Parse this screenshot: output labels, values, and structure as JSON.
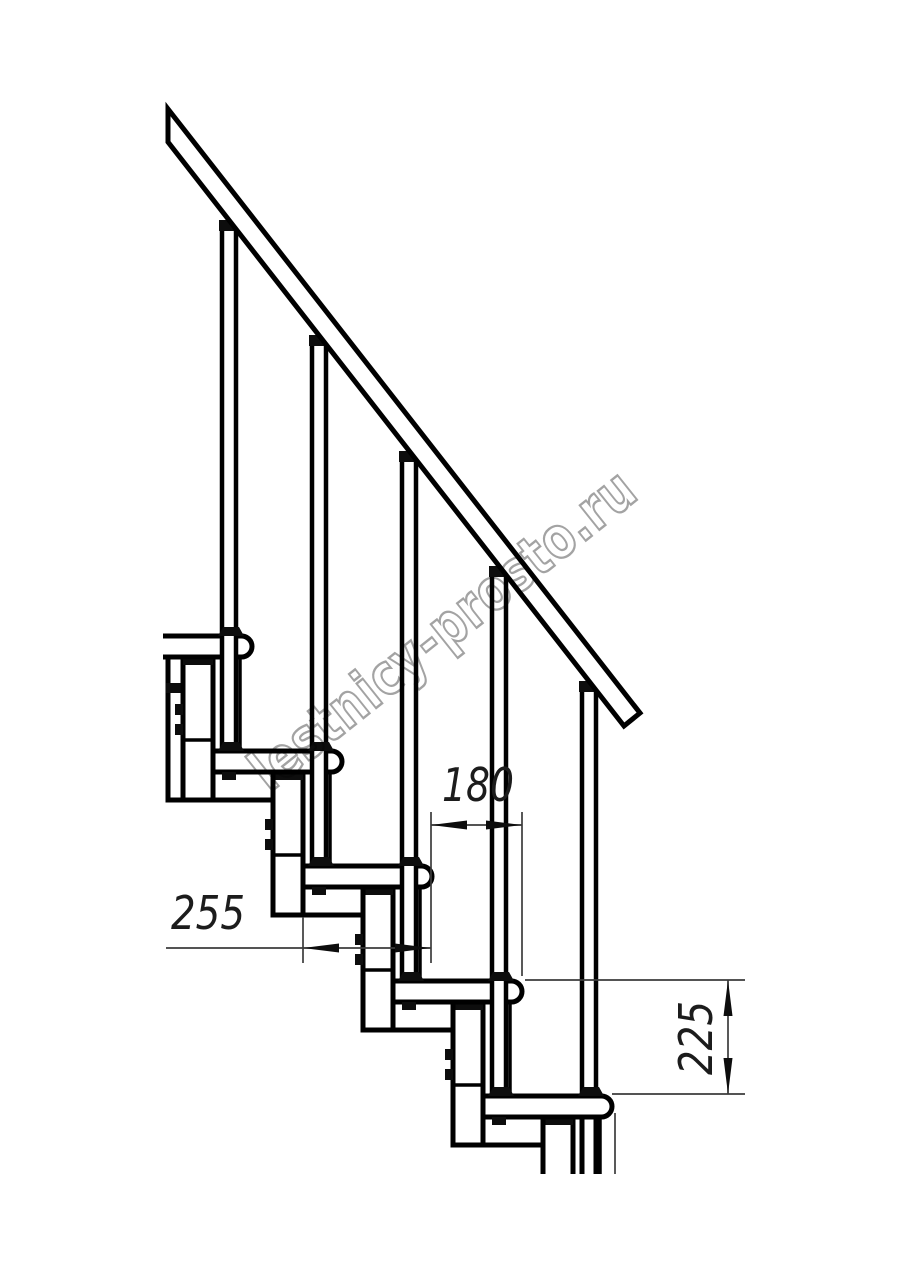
{
  "drawing": {
    "kind": "staircase-side-elevation",
    "background": "#ffffff",
    "line_color": "#000000",
    "dimension_color": "#3c3c3c",
    "tread_count": "5",
    "baluster_count": "5"
  },
  "dimensions": {
    "going": {
      "label": "180"
    },
    "tread_depth": {
      "label": "255"
    },
    "step_rise": {
      "label": "225"
    }
  },
  "watermark": {
    "text": "lestnicy-prosto.ru",
    "color": "#a3a3a3"
  }
}
